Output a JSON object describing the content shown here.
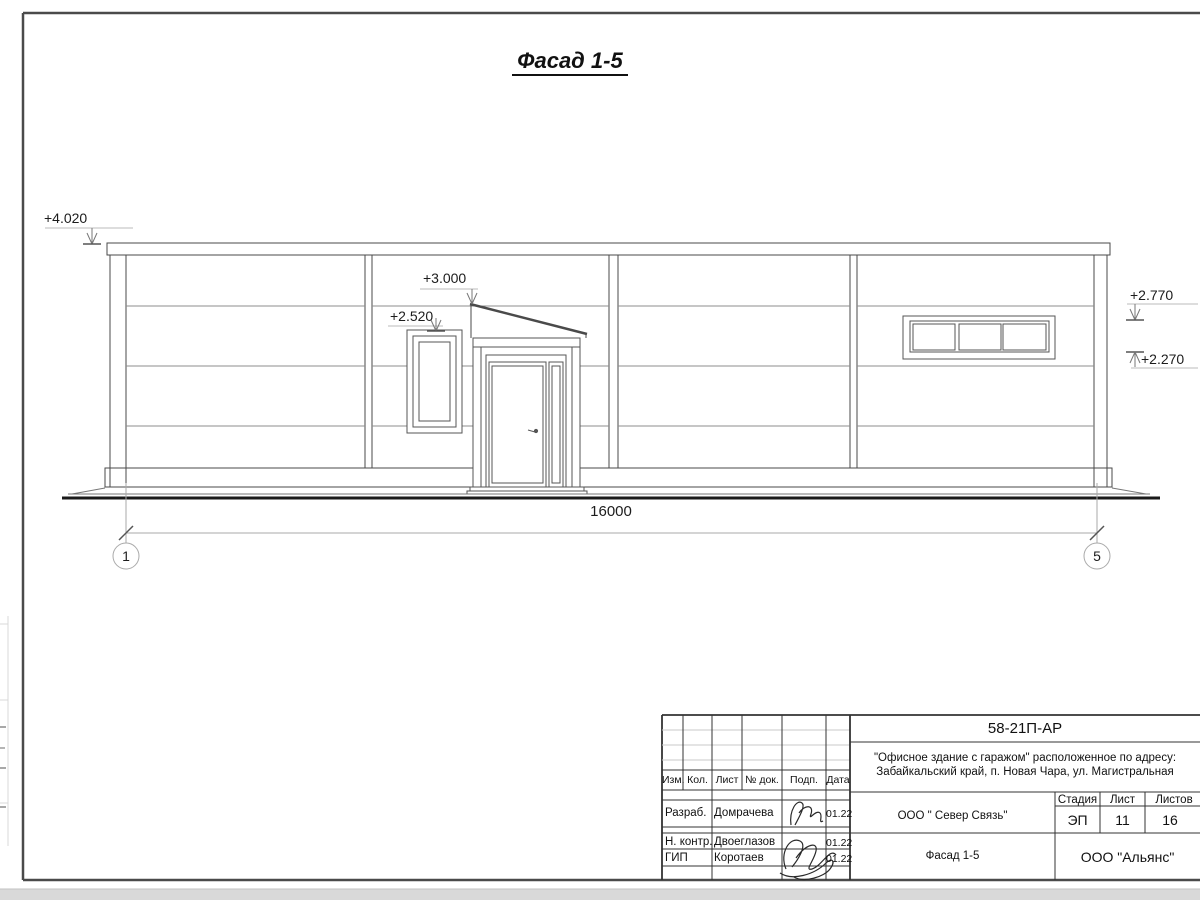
{
  "sheet": {
    "drawing_title": "Фасад 1-5",
    "dimension_total": "16000",
    "axis_left": "1",
    "axis_right": "5",
    "elevation_marks": {
      "parapet": "+4.020",
      "canopy": "+3.000",
      "entry_window": "+2.520",
      "ribbon_window_top": "+2.770",
      "ribbon_window_bottom": "+2.270"
    }
  },
  "title_block": {
    "doc_code": "58-21П-АР",
    "project_line1": "\"Офисное здание с гаражом\" расположенное по адресу:",
    "project_line2": "Забайкальский край, п. Новая Чара, ул. Магистральная",
    "columns": {
      "izm": "Изм.",
      "kol": "Кол.",
      "list": "Лист",
      "doc": "№ док.",
      "podp": "Подп.",
      "data": "Дата"
    },
    "stage_label": "Стадия",
    "sheet_label": "Лист",
    "sheets_label": "Листов",
    "stage": "ЭП",
    "sheet_no": "11",
    "sheets_total": "16",
    "rows": [
      {
        "role": "Разраб.",
        "name": "Домрачева",
        "date": "01.22"
      },
      {
        "role": "Н. контр.",
        "name": "Двоеглазов",
        "date": "01.22"
      },
      {
        "role": "ГИП",
        "name": "Коротаев",
        "date": "01.22"
      }
    ],
    "org": "ООО \" Север Связь\"",
    "view_title": "Фасад 1-5",
    "company": "ООО \"Альянс\""
  }
}
